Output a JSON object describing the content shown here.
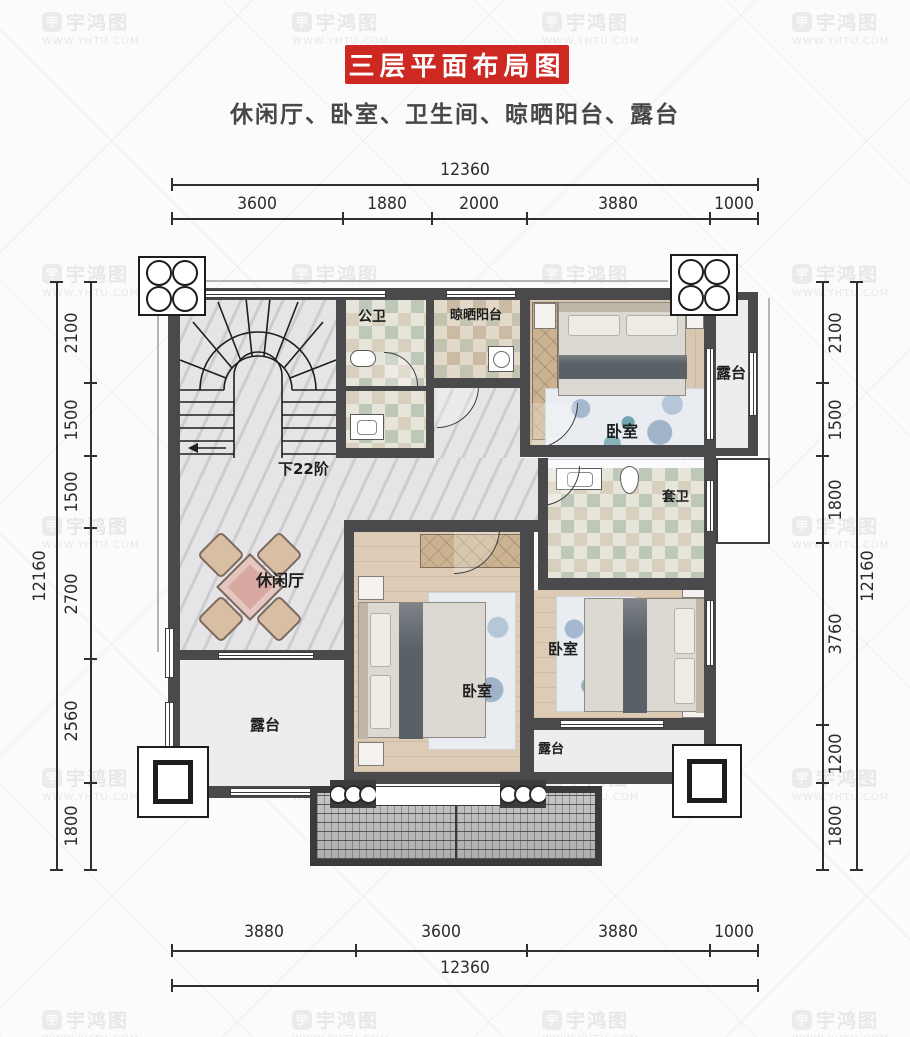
{
  "title": "三层平面布局图",
  "subtitle": "休闲厅、卧室、卫生间、晾晒阳台、露台",
  "stair_note": "下22阶",
  "watermark": {
    "brand": "宇鸿图",
    "url": "WWW.YHTU.COM",
    "logo_glyph": "宇"
  },
  "colors": {
    "title_bg": "#ce2823",
    "wall": "#4a4a4d",
    "roof_border": "#3a3a3c"
  },
  "rooms": [
    {
      "id": "public-bath",
      "label": "公卫"
    },
    {
      "id": "drying-balcony",
      "label": "晾晒阳台"
    },
    {
      "id": "bedroom-top",
      "label": "卧室"
    },
    {
      "id": "terrace-right",
      "label": "露台"
    },
    {
      "id": "ensuite-bath",
      "label": "套卫"
    },
    {
      "id": "leisure-hall",
      "label": "休闲厅"
    },
    {
      "id": "terrace-left",
      "label": "露台"
    },
    {
      "id": "bedroom-center",
      "label": "卧室"
    },
    {
      "id": "bedroom-right",
      "label": "卧室"
    },
    {
      "id": "terrace-bottom",
      "label": "露台"
    }
  ],
  "dims": {
    "top": {
      "total": "12360",
      "segments": [
        "3600",
        "1880",
        "2000",
        "3880",
        "1000"
      ]
    },
    "bottom": {
      "total": "12360",
      "segments": [
        "3880",
        "3600",
        "3880",
        "1000"
      ]
    },
    "left": {
      "total": "12160",
      "segments": [
        "2100",
        "1500",
        "1500",
        "2700",
        "2560",
        "1800"
      ]
    },
    "right": {
      "total": "12160",
      "segments": [
        "2100",
        "1500",
        "1800",
        "3760",
        "1200",
        "1800"
      ]
    }
  }
}
